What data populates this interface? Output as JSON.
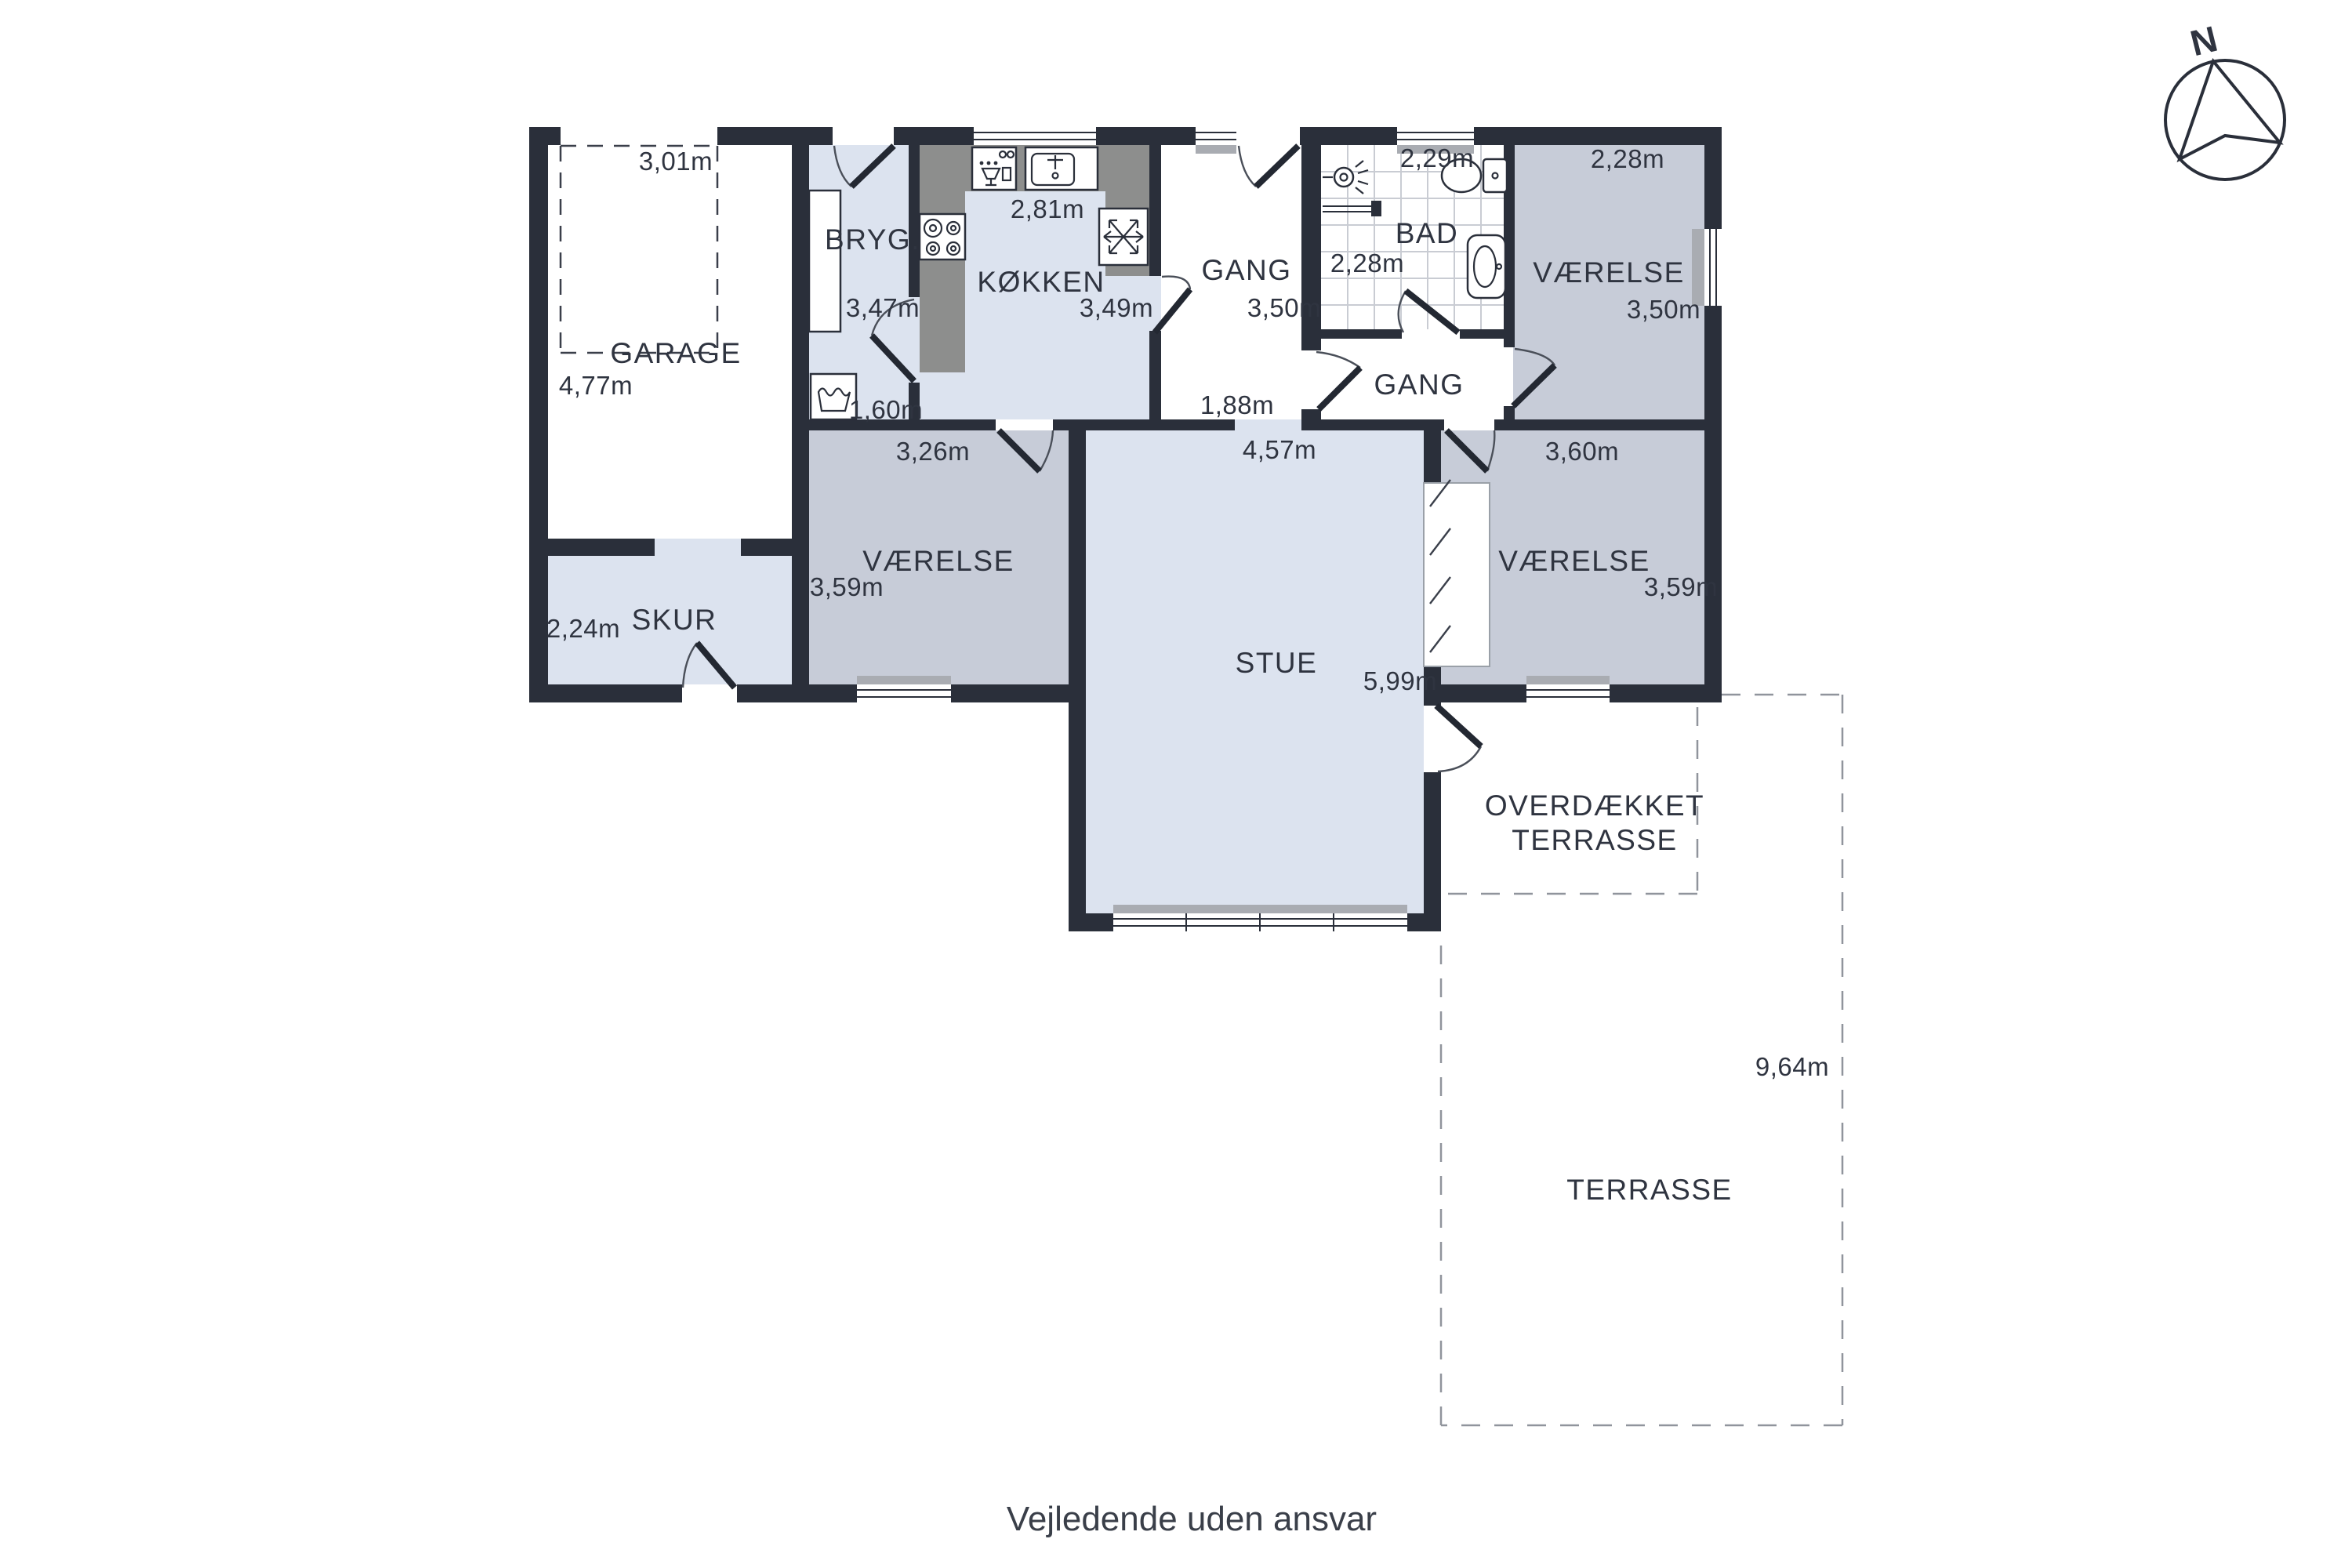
{
  "disclaimer": "Vejledende uden ansvar",
  "compass": {
    "north_label": "N"
  },
  "colors": {
    "wall": "#2a2f3a",
    "floor_light": "#dce3ef",
    "floor_gray": "#c7ccd8",
    "kitchen_counter": "#8d8e8d",
    "dashed_outline": "#90949c",
    "text": "#2f3440"
  },
  "icons": {
    "compass": "compass-rose-icon",
    "washing_machine": "washing-machine-icon",
    "dishwasher": "dishwasher-icon",
    "kitchen_sink": "kitchen-sink-icon",
    "stove": "stove-icon",
    "freezer": "freezer-snowflake-icon",
    "shower": "shower-icon",
    "toilet": "toilet-icon",
    "bathroom_sink": "bathroom-sink-icon",
    "wardrobe": "wardrobe-icon"
  },
  "rooms": [
    {
      "id": "garage",
      "label": "GARAGE",
      "dims": {
        "width": "3,01m",
        "depth": "4,77m"
      }
    },
    {
      "id": "skur",
      "label": "SKUR",
      "dims": {
        "width": "2,24m"
      }
    },
    {
      "id": "bryggers",
      "label": "BRYG.",
      "dims": {
        "depth": "3,47m",
        "width": "1,60m"
      }
    },
    {
      "id": "koekken",
      "label": "KØKKEN",
      "dims": {
        "width": "2,81m",
        "depth": "3,49m"
      }
    },
    {
      "id": "gang-entre",
      "label": "GANG",
      "dims": {
        "depth": "3,50m",
        "width": "1,88m"
      }
    },
    {
      "id": "bad",
      "label": "BAD",
      "dims": {
        "width": "2,29m",
        "depth": "2,28m"
      }
    },
    {
      "id": "gang-fordeler",
      "label": "GANG",
      "dims": {}
    },
    {
      "id": "vaerelse-nordoest",
      "label": "VÆRELSE",
      "dims": {
        "width": "2,28m",
        "depth": "3,50m"
      }
    },
    {
      "id": "vaerelse-vest",
      "label": "VÆRELSE",
      "dims": {
        "width": "3,26m",
        "depth": "3,59m"
      }
    },
    {
      "id": "stue",
      "label": "STUE",
      "dims": {
        "width": "4,57m",
        "depth": "5,99m"
      }
    },
    {
      "id": "vaerelse-syd",
      "label": "VÆRELSE",
      "dims": {
        "width": "3,60m",
        "depth": "3,59m"
      }
    },
    {
      "id": "overdaekket-terrasse",
      "label_line1": "OVERDÆKKET",
      "label_line2": "TERRASSE",
      "dims": {}
    },
    {
      "id": "terrasse",
      "label": "TERRASSE",
      "dims": {
        "depth": "9,64m"
      }
    }
  ]
}
